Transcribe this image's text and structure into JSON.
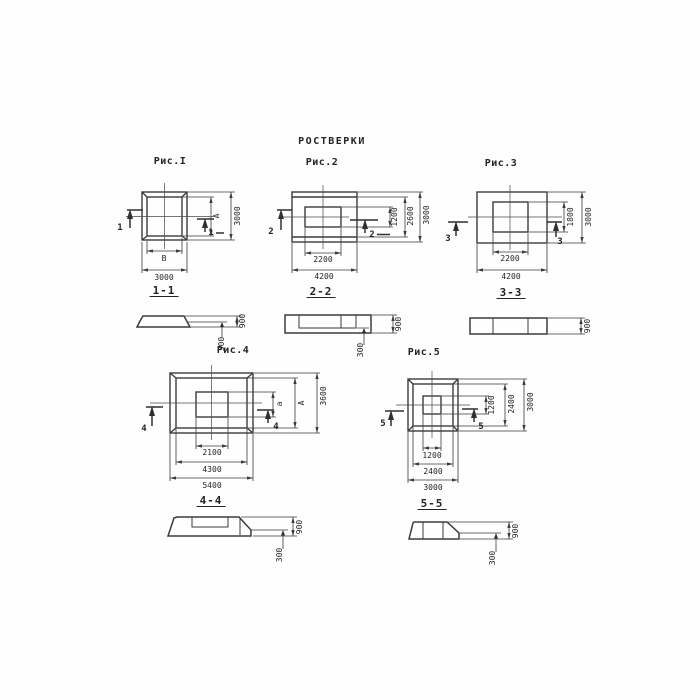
{
  "title": "РОСТВЕРКИ",
  "fig1": {
    "caption": "Рис.I",
    "marker": "1",
    "section_label": "1-1",
    "dim_b_inner": "В",
    "dim_b_outer": "3000",
    "dim_r_inner": "А",
    "dim_r_outer": "3000"
  },
  "fig2": {
    "caption": "Рис.2",
    "marker": "2",
    "section_label": "2-2",
    "dim_b_inner": "2200",
    "dim_b_outer": "4200",
    "dim_r_inner": "1200",
    "dim_r_mid": "2600",
    "dim_r_outer": "3000"
  },
  "fig3": {
    "caption": "Рис.3",
    "marker": "3",
    "section_label": "3-3",
    "dim_b_inner": "2200",
    "dim_b_outer": "4200",
    "dim_r_inner": "1800",
    "dim_r_outer": "3000"
  },
  "fig4": {
    "caption": "Рис.4",
    "marker": "4",
    "section_label": "4-4",
    "dim_b_inner": "2100",
    "dim_b_mid": "4300",
    "dim_b_outer": "5400",
    "dim_r_inner": "а",
    "dim_r_mid": "А",
    "dim_r_outer": "3600"
  },
  "fig5": {
    "caption": "Рис.5",
    "marker": "5",
    "section_label": "5-5",
    "dim_b_inner": "1200",
    "dim_b_mid": "2400",
    "dim_b_outer": "3000",
    "dim_r_inner": "1200",
    "dim_r_mid": "2400",
    "dim_r_outer": "3000"
  },
  "sections": {
    "s1": {
      "total": "900",
      "edge": "300"
    },
    "s2": {
      "total": "900",
      "edge": "300"
    },
    "s3": {
      "total": "900"
    },
    "s4": {
      "total": "900",
      "edge": "300"
    },
    "s5": {
      "total": "900",
      "edge": "300"
    }
  }
}
